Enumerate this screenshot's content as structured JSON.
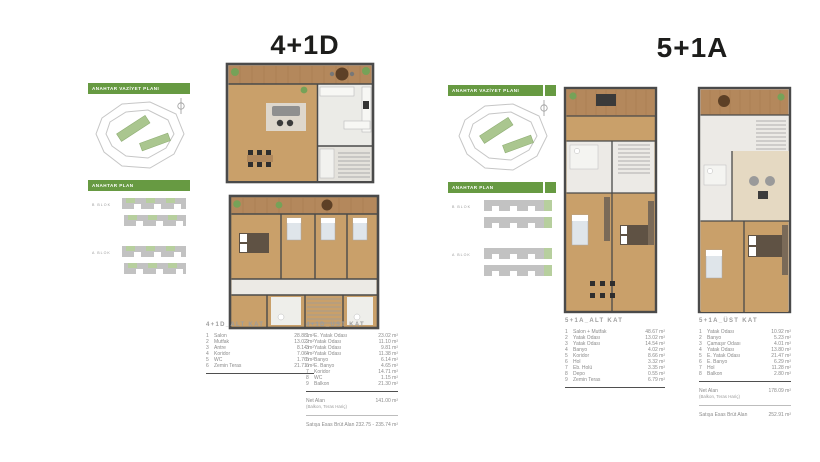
{
  "colors": {
    "accent_green": "#679a42",
    "highlight_green": "#b7cf9e",
    "plan_wood": "#c9a06a",
    "plan_deck": "#b4885c",
    "plan_wall": "#4a4a4a"
  },
  "left": {
    "title": "4+1D",
    "sidebar": {
      "vaziyet_label": "ANAHTAR VAZİYET PLANI",
      "anahtar_label": "ANAHTAR PLAN",
      "block_label_1": "B BLOK",
      "block_label_2": "A BLOK"
    },
    "alt": {
      "heading": "4+1D_ALT KAT",
      "rooms": [
        {
          "no": "1",
          "name": "Salon",
          "area": "28.88 m²"
        },
        {
          "no": "2",
          "name": "Mutfak",
          "area": "13.02 m²"
        },
        {
          "no": "3",
          "name": "Antre",
          "area": "8.14 m²"
        },
        {
          "no": "4",
          "name": "Koridor",
          "area": "7.06 m²"
        },
        {
          "no": "5",
          "name": "WC",
          "area": "1.76 m²"
        },
        {
          "no": "6",
          "name": "Zemin Teras",
          "area": "21.71 m²"
        }
      ]
    },
    "ust": {
      "heading": "4+1D_ÜST KAT",
      "rooms": [
        {
          "no": "1",
          "name": "E. Yatak Odası",
          "area": "23.02 m²"
        },
        {
          "no": "2",
          "name": "Yatak Odası",
          "area": "11.10 m²"
        },
        {
          "no": "3",
          "name": "Yatak Odası",
          "area": "9.81 m²"
        },
        {
          "no": "4",
          "name": "Yatak Odası",
          "area": "11.38 m²"
        },
        {
          "no": "5",
          "name": "Banyo",
          "area": "6.14 m²"
        },
        {
          "no": "6",
          "name": "E. Banyo",
          "area": "4.65 m²"
        },
        {
          "no": "7",
          "name": "Koridor",
          "area": "14.71 m²"
        },
        {
          "no": "8",
          "name": "WC",
          "area": "1.15 m²"
        },
        {
          "no": "9",
          "name": "Balkon",
          "area": "21.30 m²"
        }
      ],
      "net_label": "Net Alan",
      "net_sub": "(Balkon, Teras Hariç)",
      "net_value": "141.00 m²",
      "brut_label": "Satışa Esas Brüt Alan",
      "brut_value": "232.75 - 235.74 m²"
    }
  },
  "right": {
    "title": "5+1A",
    "sidebar": {
      "vaziyet_label": "ANAHTAR VAZİYET PLANI",
      "anahtar_label": "ANAHTAR PLAN",
      "block_label_1": "B BLOK",
      "block_label_2": "A BLOK"
    },
    "alt": {
      "heading": "5+1A_ALT KAT",
      "rooms": [
        {
          "no": "1",
          "name": "Salon + Mutfak",
          "area": "48.67 m²"
        },
        {
          "no": "2",
          "name": "Yatak Odası",
          "area": "13.02 m²"
        },
        {
          "no": "3",
          "name": "Yatak Odası",
          "area": "14.54 m²"
        },
        {
          "no": "4",
          "name": "Banyo",
          "area": "4.02 m²"
        },
        {
          "no": "5",
          "name": "Koridor",
          "area": "8.66 m²"
        },
        {
          "no": "6",
          "name": "Hol",
          "area": "3.32 m²"
        },
        {
          "no": "7",
          "name": "Eb. Holü",
          "area": "3.35 m²"
        },
        {
          "no": "8",
          "name": "Depo",
          "area": "0.55 m²"
        },
        {
          "no": "9",
          "name": "Zemin Teras",
          "area": "6.79 m²"
        }
      ]
    },
    "ust": {
      "heading": "5+1A_ÜST KAT",
      "rooms": [
        {
          "no": "1",
          "name": "Yatak Odası",
          "area": "10.92 m²"
        },
        {
          "no": "2",
          "name": "Banyo",
          "area": "5.23 m²"
        },
        {
          "no": "3",
          "name": "Çamaşır Odası",
          "area": "4.01 m²"
        },
        {
          "no": "4",
          "name": "Yatak Odası",
          "area": "13.80 m²"
        },
        {
          "no": "5",
          "name": "E. Yatak Odası",
          "area": "21.47 m²"
        },
        {
          "no": "6",
          "name": "E. Banyo",
          "area": "6.29 m²"
        },
        {
          "no": "7",
          "name": "Hol",
          "area": "11.28 m²"
        },
        {
          "no": "8",
          "name": "Balkon",
          "area": "2.80 m²"
        }
      ],
      "net_label": "Net Alan",
      "net_sub": "(Balkon, Teras Hariç)",
      "net_value": "178.09 m²",
      "brut_label": "Satışa Esas Brüt Alan",
      "brut_value": "252.91 m²"
    }
  }
}
